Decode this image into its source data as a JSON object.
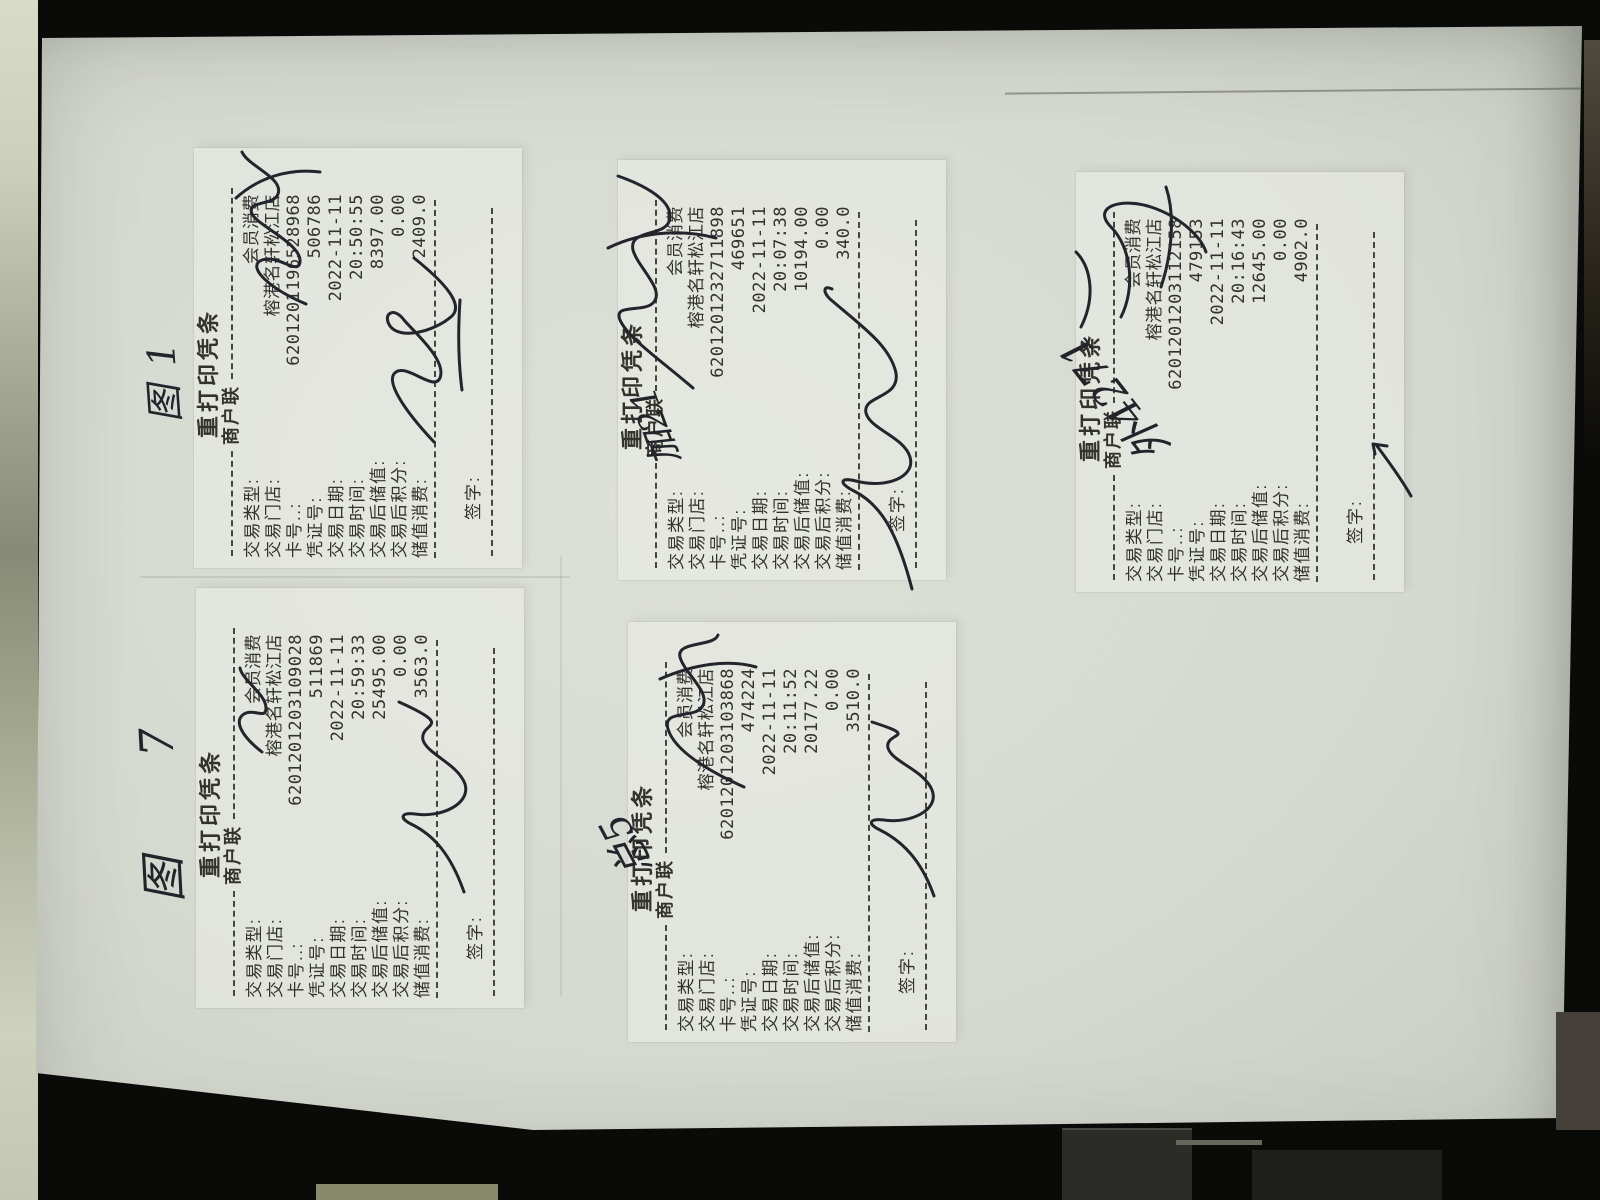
{
  "scene": {
    "description": "photo of a sheet of paper on a dark desk with five reprinted POS receipts rotated 90 degrees",
    "colors": {
      "background": "#0a0a08",
      "paper": "#d5d9d0",
      "ink": "#32332d",
      "pen": "#23242c",
      "side_strip": "#cdd1bb"
    }
  },
  "receipt_template": {
    "title": "重打印凭条",
    "copy_label": "商户联",
    "labels": {
      "type": "交易类型:",
      "store": "交易门店:",
      "card_no": "卡号..:",
      "voucher_no": "凭证号:",
      "date": "交易日期:",
      "time": "交易时间:",
      "balance_after": "交易后储值:",
      "points_after": "交易后积分:",
      "stored_value_spent": "储值消费:",
      "sign": "签字:"
    }
  },
  "receipts": [
    {
      "type": "会员消费",
      "store": "榕港名轩松江店",
      "card_no": "6201201196528968",
      "voucher_no": "506786",
      "date": "2022-11-11",
      "time": "20:50:55",
      "balance_after": "8397.00",
      "points_after": "0.00",
      "stored_value_spent": "2409.0",
      "tag": "图1",
      "has_name_scribble": true,
      "has_signature": true
    },
    {
      "type": "会员消费",
      "store": "榕港名轩松江店",
      "card_no": "6201201232711898",
      "voucher_no": "469651",
      "date": "2022-11-11",
      "time": "20:07:38",
      "balance_after": "10194.00",
      "points_after": "0.00",
      "stored_value_spent": "340.0",
      "tag": "加21",
      "has_name_scribble": true,
      "has_signature": true
    },
    {
      "type": "会员消费",
      "store": "榕港名轩松江店",
      "card_no": "6201201203112158",
      "voucher_no": "479153",
      "date": "2022-11-11",
      "time": "20:16:43",
      "balance_after": "12645.00",
      "points_after": "0.00",
      "stored_value_spent": "4902.0",
      "tag": "外4271",
      "has_name_scribble": true,
      "has_signature": true
    },
    {
      "type": "会员消费",
      "store": "榕港名轩松江店",
      "card_no": "6201201203109028",
      "voucher_no": "511869",
      "date": "2022-11-11",
      "time": "20:59:33",
      "balance_after": "25495.00",
      "points_after": "0.00",
      "stored_value_spent": "3563.0",
      "tag": "图7",
      "has_name_scribble": true,
      "has_signature": true
    },
    {
      "type": "会员消费",
      "store": "榕港名轩松江店",
      "card_no": "6201201203103868",
      "voucher_no": "474224",
      "date": "2022-11-11",
      "time": "20:11:52",
      "balance_after": "20177.22",
      "points_after": "0.00",
      "stored_value_spent": "3510.0",
      "tag": "总5",
      "has_name_scribble": true,
      "has_signature": true
    }
  ]
}
